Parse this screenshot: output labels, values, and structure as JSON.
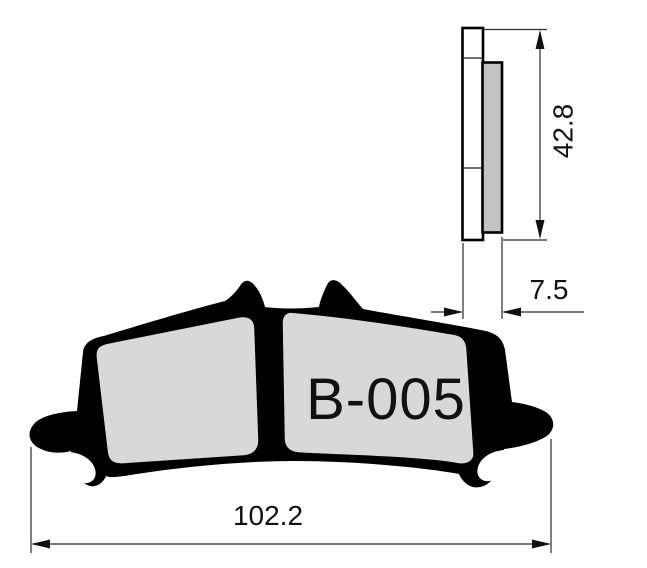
{
  "drawing": {
    "title": "brake-pad-technical-drawing",
    "part": {
      "label": "B-005"
    },
    "dimensions": {
      "pad_height_mm": "42.8",
      "pad_thickness_mm": "7.5",
      "pad_width_mm": "102.2"
    },
    "colors": {
      "background": "#ffffff",
      "outline": "#000000",
      "dimension_line": "#2b2b2b",
      "text": "#111111",
      "friction_front_fill": "#d8d8d8",
      "friction_side_fill": "#c2c2c2",
      "backplate_side_fill": "#ffffff",
      "loop_opening_fill": "#ffffff"
    }
  }
}
